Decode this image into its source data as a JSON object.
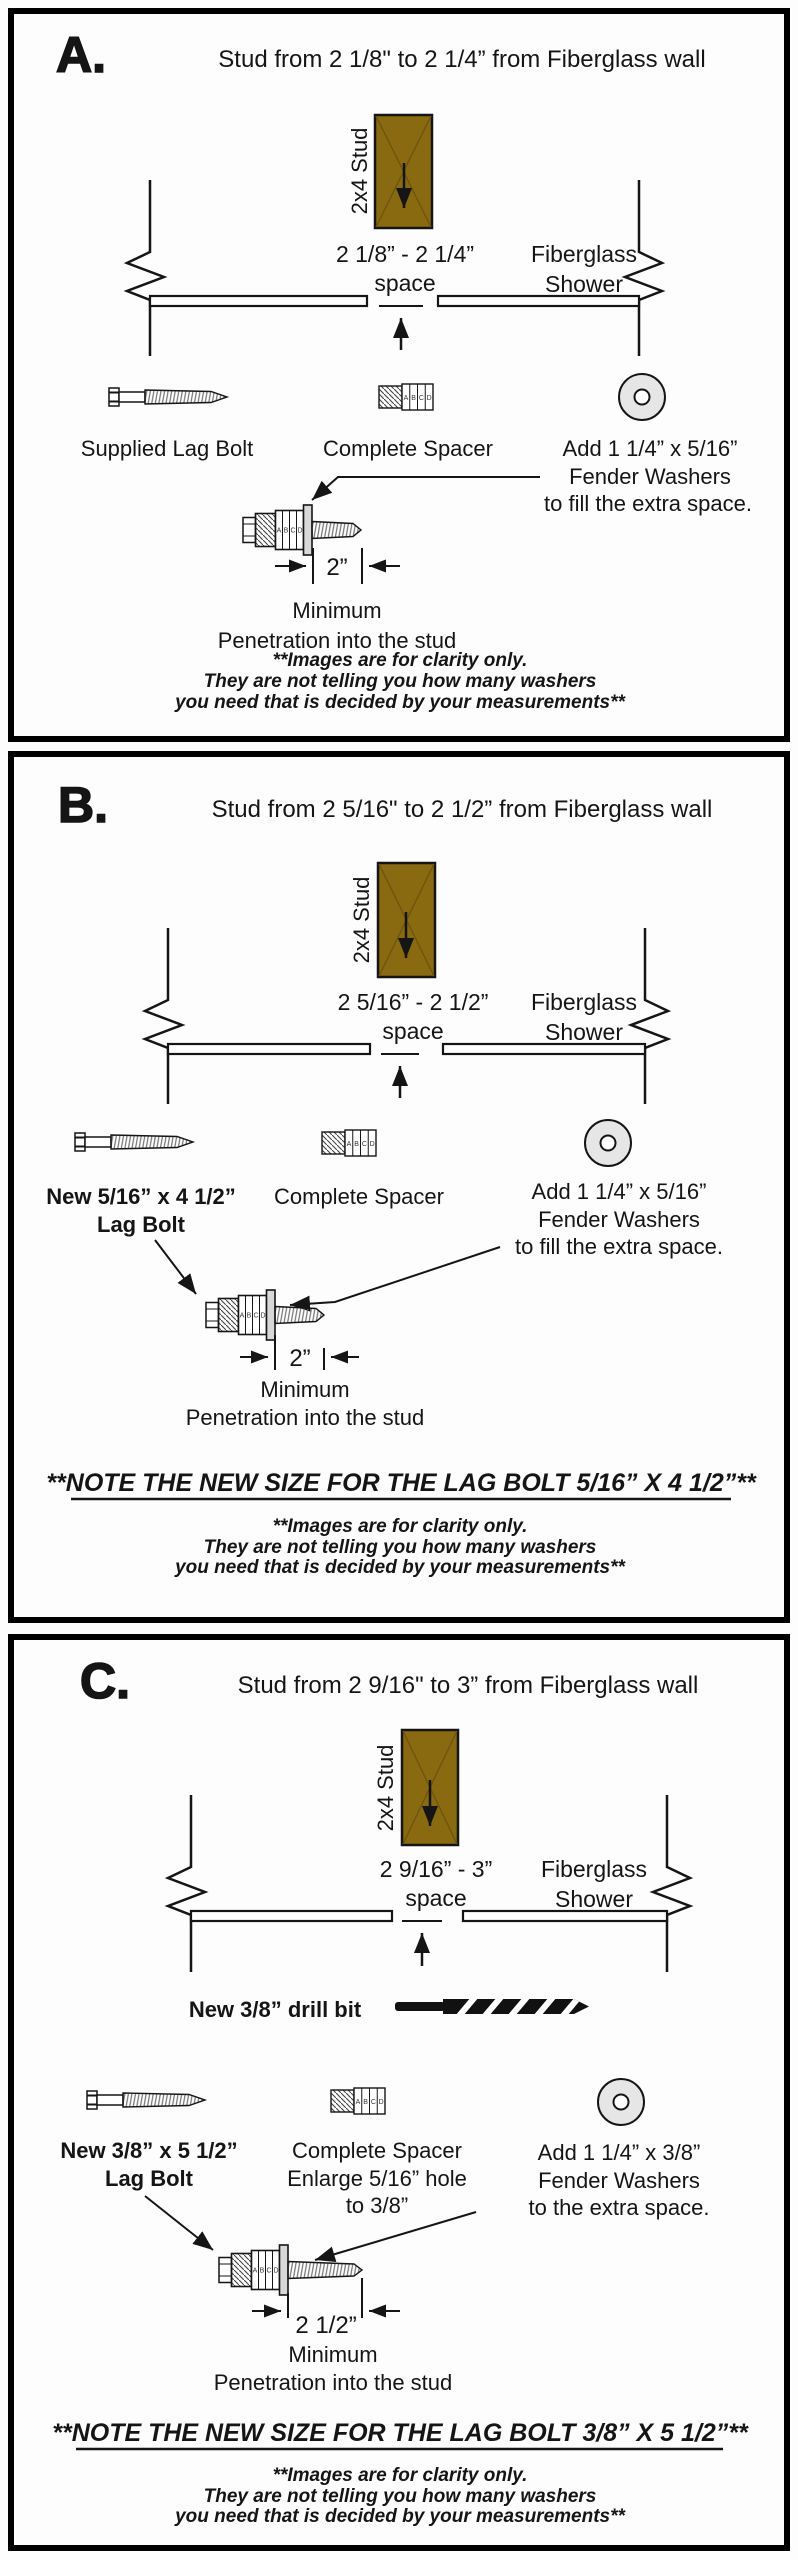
{
  "shared": {
    "stud_label": "2x4 Stud",
    "space_word": "space",
    "fiberglass_line1": "Fiberglass",
    "fiberglass_line2": "Shower",
    "spacer_segments": [
      "A",
      "B",
      "C",
      "D"
    ],
    "minimum_label": "Minimum",
    "penetration_label": "Penetration into the stud",
    "disclaimer": [
      "**Images are for clarity only.",
      "They are not telling you how many washers",
      "you need that is decided by your measurements**"
    ],
    "colors": {
      "stud_fill": "#8a6a10",
      "washer_fill": "#e6e6e6",
      "ink": "#151515"
    }
  },
  "panel_a": {
    "letter": "A.",
    "title": "Stud from 2 1/8\" to 2 1/4” from Fiberglass wall",
    "space_range": "2 1/8” - 2 1/4”",
    "lag_bolt_label": "Supplied Lag Bolt",
    "spacer_label": "Complete Spacer",
    "washer_label": [
      "Add 1 1/4” x 5/16”",
      "Fender Washers",
      "to fill the extra space."
    ],
    "dimension": "2”"
  },
  "panel_b": {
    "letter": "B.",
    "title": "Stud from 2 5/16\" to 2 1/2” from Fiberglass wall",
    "space_range": "2 5/16” - 2 1/2”",
    "lag_bolt_label": [
      "New 5/16” x 4 1/2”",
      "Lag Bolt"
    ],
    "spacer_label": "Complete Spacer",
    "washer_label": [
      "Add 1 1/4” x 5/16”",
      "Fender Washers",
      "to fill the extra space."
    ],
    "dimension": "2”",
    "note": "**NOTE THE NEW SIZE FOR THE LAG BOLT 5/16” X 4 1/2”**"
  },
  "panel_c": {
    "letter": "C.",
    "title": "Stud from 2 9/16\" to 3” from Fiberglass wall",
    "space_range": "2 9/16” - 3”",
    "drill_label": "New 3/8” drill bit",
    "lag_bolt_label": [
      "New 3/8” x 5 1/2”",
      "Lag Bolt"
    ],
    "spacer_label": [
      "Complete Spacer",
      "Enlarge 5/16” hole",
      "to 3/8”"
    ],
    "washer_label": [
      "Add 1 1/4” x 3/8”",
      "Fender Washers",
      "to the extra space."
    ],
    "dimension": "2 1/2”",
    "note": "**NOTE THE NEW SIZE FOR THE LAG BOLT 3/8” X 5 1/2”**"
  }
}
